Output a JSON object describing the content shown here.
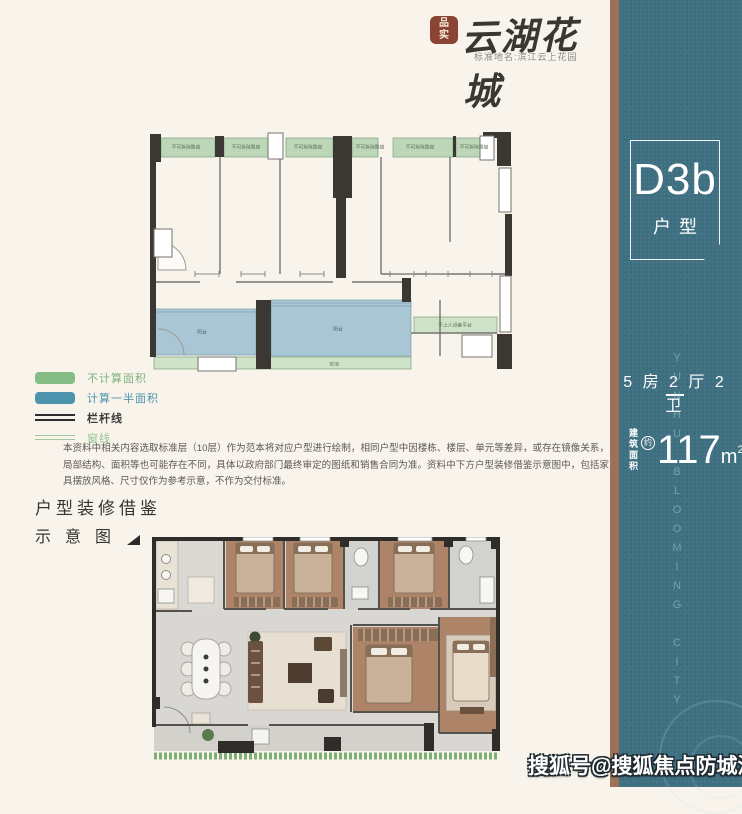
{
  "header": {
    "seal_text": "品\n实",
    "logo_title": "云湖花城",
    "logo_subtitle": "标准地名:滨江云上花园"
  },
  "sidebar": {
    "unit_code": "D3b",
    "unit_type_label": "户型",
    "spec_line": "5 房 2 厅 2 卫",
    "area_prefix_line1": "建筑",
    "area_prefix_line2": "面积",
    "area_approx_mark": "约",
    "area_value": "117",
    "area_unit": "m",
    "area_unit_sup": "2",
    "vertical_text": "YUNHU BLOOMING CITY",
    "colors": {
      "bg": "#3f7082",
      "divider_brown": "#9d7158",
      "text": "#ffffff"
    }
  },
  "schematic": {
    "top_strip_label": "不可拆除飘窗",
    "right_strip_label": "不上人设备平台",
    "balcony_label": "阳台",
    "flowerbed_label": "花池",
    "colors": {
      "no_area_green": "#bcd7b8",
      "half_area_blue": "#a9c6d5",
      "wall": "#3b3834"
    }
  },
  "legend": {
    "items": [
      {
        "label": "不计算面积",
        "swatch_color": "#86bd86"
      },
      {
        "label": "计算一半面积",
        "swatch_color": "#4e93ad"
      },
      {
        "label": "栏杆线",
        "swatch_color": "#2e2e2e"
      },
      {
        "label": "窗线",
        "swatch_color": "#9fc79b"
      }
    ]
  },
  "disclaimer": "本资料中相关内容选取标准层（10层）作为范本将对应户型进行绘制，相同户型中因楼栋、楼层、单元等差异，或存在镜像关系，局部结构、面积等也可能存在不同，具体以政府部门最终审定的图纸和销售合同为准。资料中下方户型装修借鉴示意图中，包括家具摆放风格、尺寸仅作为参考示意，不作为交付标准。",
  "section": {
    "title_line1": "户型装修借鉴",
    "title_line2": "示意图"
  },
  "watermark": "搜狐号@搜狐焦点防城港站"
}
